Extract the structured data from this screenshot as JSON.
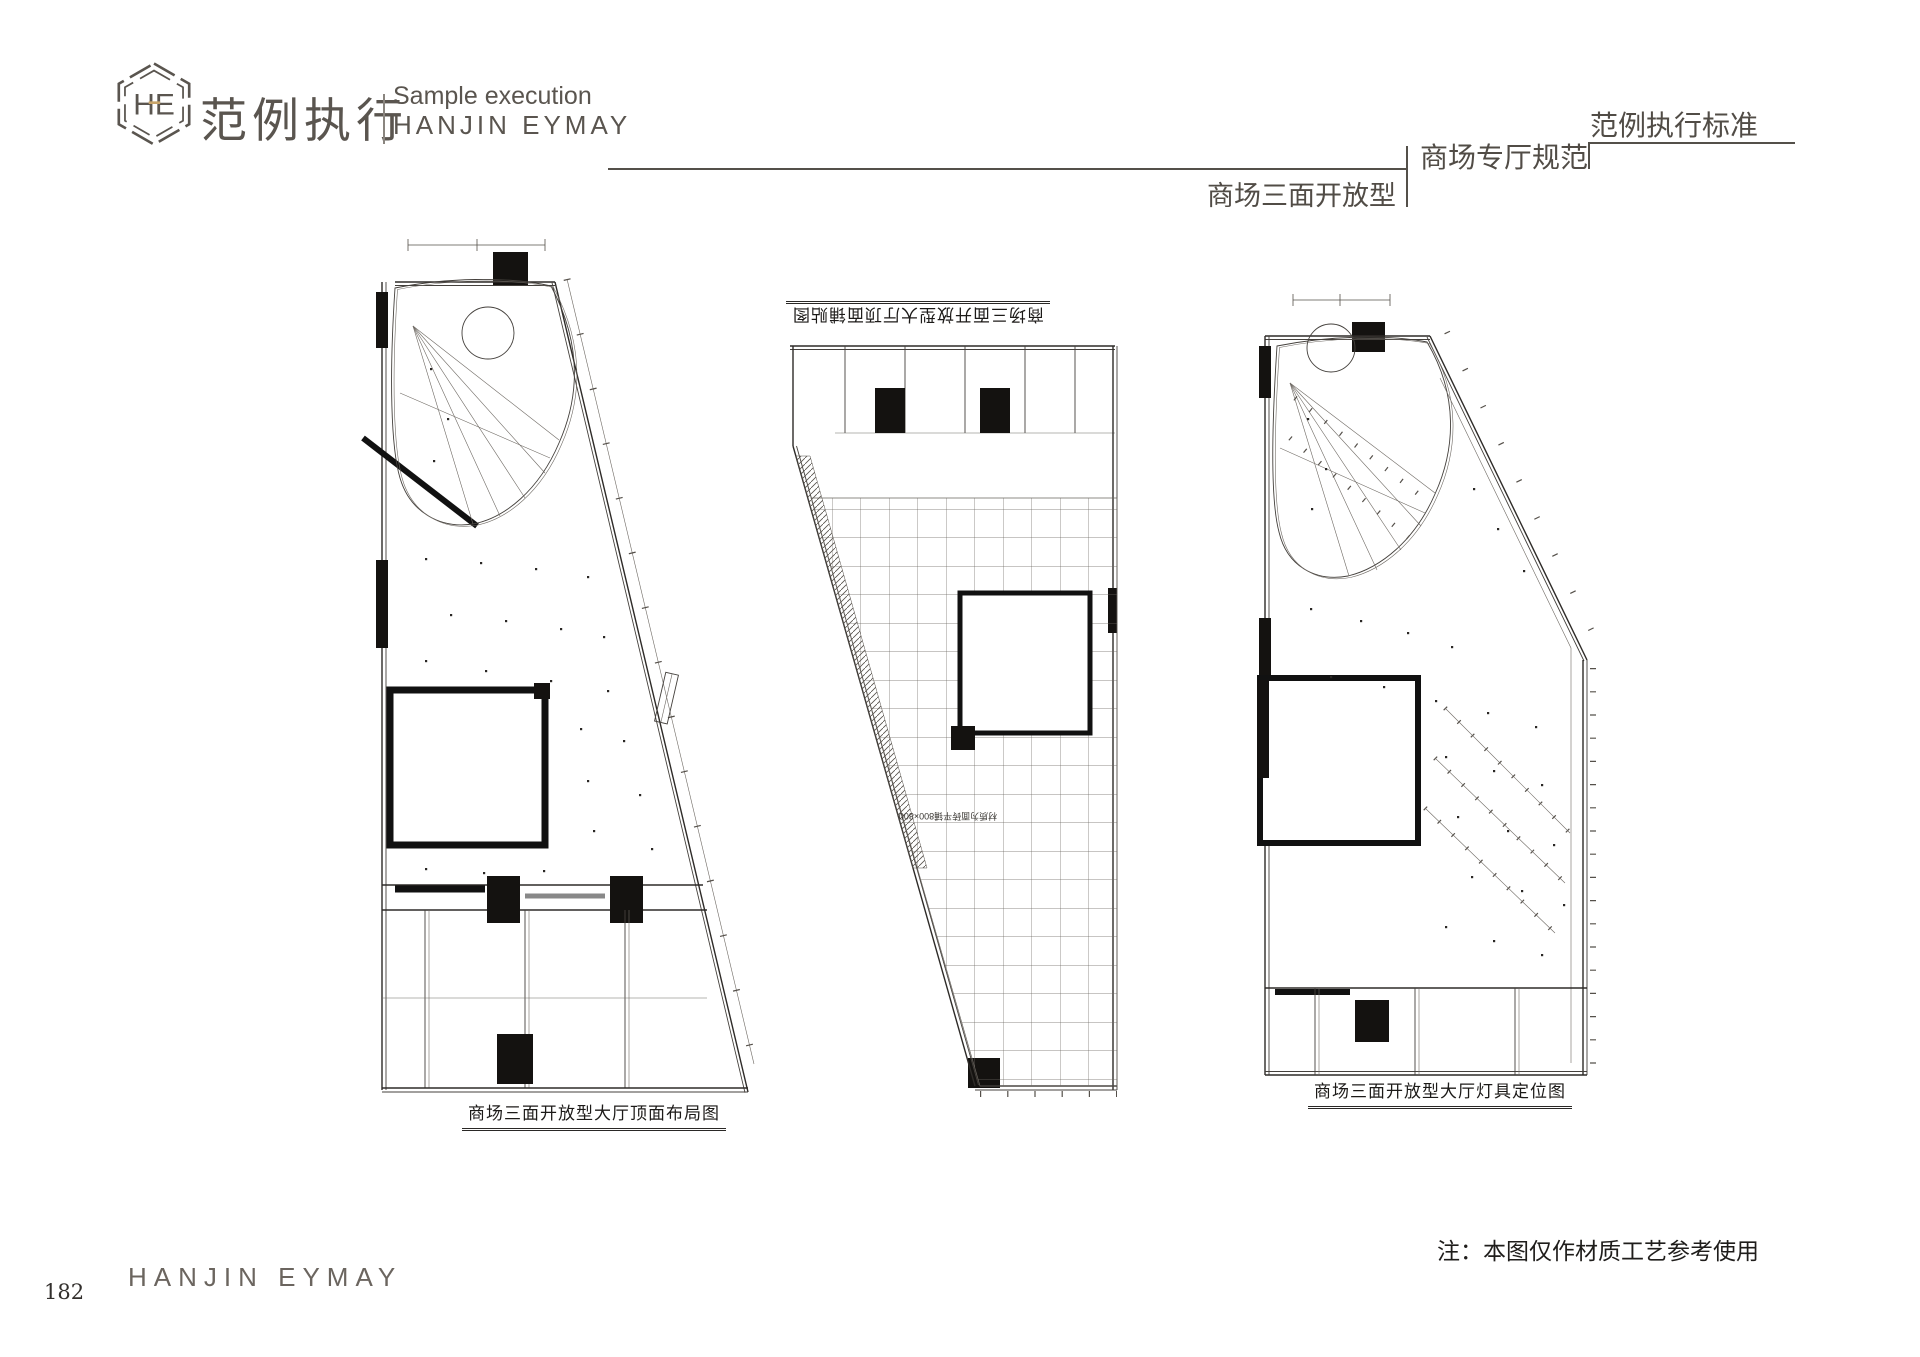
{
  "page": {
    "background": "#ffffff"
  },
  "header": {
    "logo": {
      "monogram": "HE",
      "brand_cn": "范例执行",
      "tagline_en": "Sample execution",
      "brand_en": "HANJIN EYMAY"
    },
    "right": {
      "standard_label": "范例执行标准",
      "section_label": "商场专厅规范",
      "page_title": "商场三面开放型"
    },
    "colors": {
      "ink": "#55504a",
      "gold": "#c9a56a"
    }
  },
  "drawings": {
    "left": {
      "caption": "商场三面开放型大厅顶面布局图"
    },
    "middle": {
      "caption": "商场三面开放型大厅顶面铺贴图",
      "tile_annotation": "材质为面砖平铺800×800"
    },
    "right": {
      "caption": "商场三面开放型大厅灯具定位图"
    }
  },
  "footer": {
    "brand_en": "HANJIN EYMAY",
    "note": "注：本图仅作材质工艺参考使用",
    "page_number": "182"
  }
}
